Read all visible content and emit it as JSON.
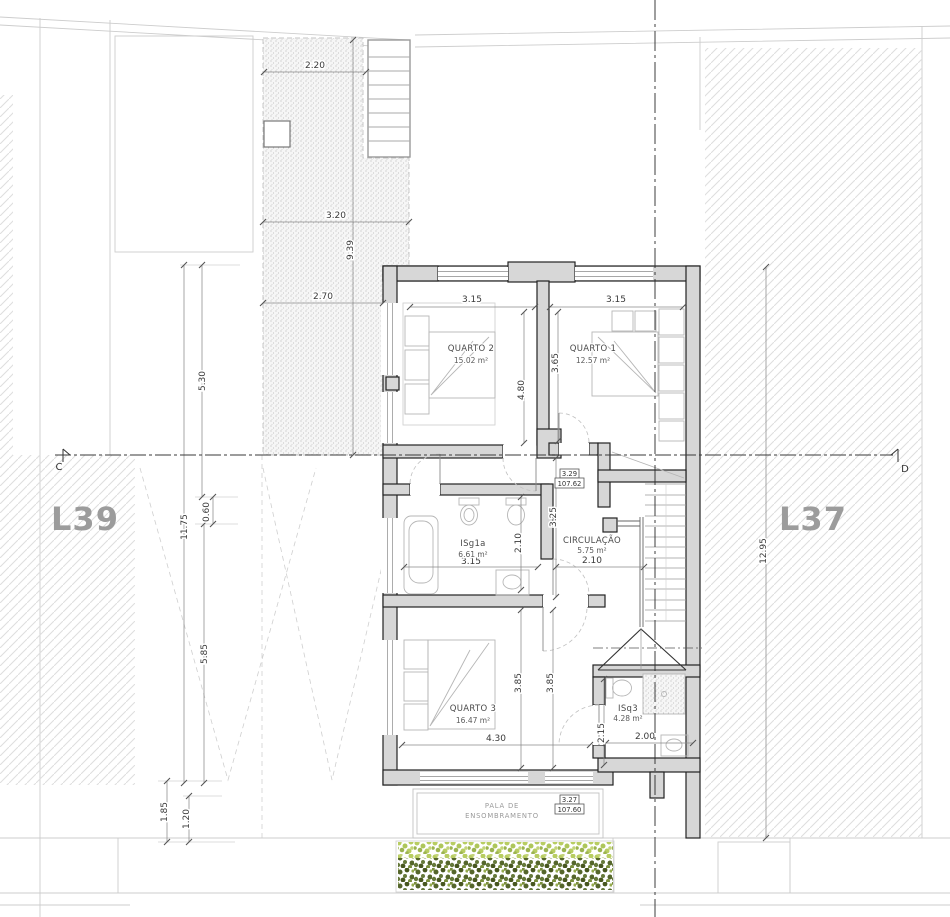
{
  "plan": {
    "lot_left_label": "L39",
    "lot_right_label": "L37",
    "section_marker_left": "C",
    "section_marker_right": "D"
  },
  "rooms": {
    "quarto2": {
      "name": "QUARTO 2",
      "area": "15.02 m²"
    },
    "quarto1": {
      "name": "QUARTO 1",
      "area": "12.57 m²"
    },
    "isg1a": {
      "name": "ISg1a",
      "area": "6.61 m²"
    },
    "circulacao": {
      "name": "CIRCULAÇÃO",
      "area": "5.75 m²"
    },
    "quarto3": {
      "name": "QUARTO 3",
      "area": "16.47 m²"
    },
    "isq3": {
      "name": "ISq3",
      "area": "4.28 m²"
    }
  },
  "levels": {
    "upper": {
      "height": "3.29",
      "elevation": "107.62"
    },
    "lower": {
      "height": "3.27",
      "elevation": "107.60"
    }
  },
  "canopy": {
    "line1": "PALA DE",
    "line2": "ENSOMBRAMENTO"
  },
  "dims": {
    "patio_top": "2.20",
    "patio_mid": "3.20",
    "patio_depth": "9.39",
    "patio_bottom": "2.70",
    "site_upper": "5.30",
    "site_total": "11.75",
    "site_offset": "0.60",
    "site_lower": "5.85",
    "site_canopy_a": "1.85",
    "site_canopy_b": "1.20",
    "site_right": "12.95",
    "q2_width": "3.15",
    "q2_depth": "4.80",
    "q1_width": "3.15",
    "q1_depth": "3.65",
    "hall_depth": "3.25",
    "isg1a_width": "3.15",
    "isg1a_depth": "2.10",
    "circ_width": "2.10",
    "q3_width": "4.30",
    "q3_depth_a": "3.85",
    "q3_depth_b": "3.85",
    "isq3_width": "2.00",
    "isq3_depth": "2.15"
  }
}
